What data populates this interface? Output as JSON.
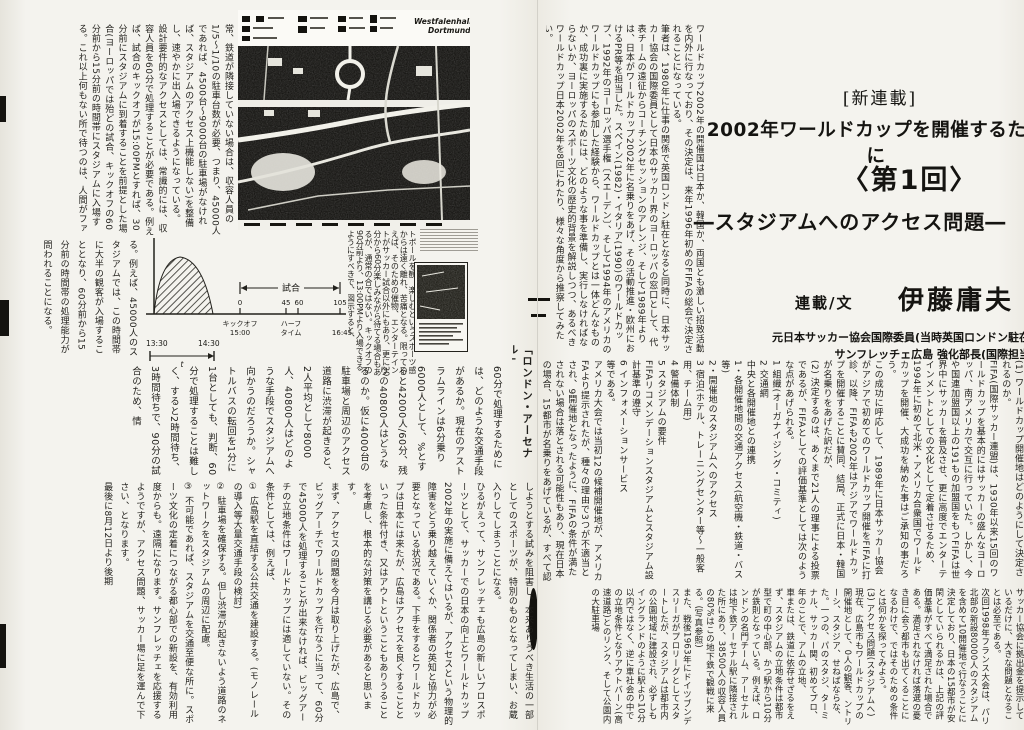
{
  "left_page": {
    "col_top_left": "常、鉄道が隣接していない場合は、収容人員の1/5〜1/10の駐車台数が必要、つまり、45000人であれば、4500台〜9000台の駐車場がなければ、スタジアムのアクセス上機能しない)を整備し、速やかに出入場できるようになっている。\n設計要件的なアクセスとしては、常識的には、収容人員を60分で処理することが必要である。例えば、試合のキックオフが15:00PMとすれば、30分前にスタジアムに到着することを前提とした場合(ヨーロッパでは殆どの試合、キックオフの60分前から15分前の時間帯にスタジアムに入場する。これ以上何もない所で待つのは、人間がファ",
    "col_below_left": "る。例えば、45000人のスタジアムでは、この時間帯に大半の観客が入場することとなり、60分前から15分前の時間帯の処理能力が問われることになる。",
    "map": {
      "title_line1": "Westfalenhallen",
      "title_line2": "Dortmund"
    },
    "col_right_of_diagram": "トボールを観、楽しむというスポーツ感からは遠く離れ、苦痛となる。限っていえば、そのための催物、エンターテイントがサッカー試合以外にもあり、更に30分から60分楽しみながら待てる場合もあるが、通常の合ではない。キックオフの90分前より、13:00PMより入場できるようにすべきで、図示すると、",
    "heading_arsenal": "「ロンドン・アーセナル」",
    "mid_band": "60分で処理するためには、どのような交通手段があるか。現在のアストラムラインは6分乗り6000人として、%とすると42000人/60分、残りの40800人はどうなるのか。仮に4000台の駐車場と周辺のアクセス道路に渋滞が起きると、2人平均として8000人、40800人はどのような手段でスタジアムへ向かうのだろうか。シャトルバスの転回を1分に1台としても、判断、60分で処理することは難しく、すると2時間待ち、3時間待ちで、90分の試合のため、情",
    "bottom_band": "しようとする試みを阻害し、本来ありうべき生活の一部としてのスポーツが、特別のものとなってしまい、お蔵入りしてしまうことになる。\nひるがえって、サンフレッチェも広島の新しいプロスポーツとして、サッカーでの日本の向上とワールドカップ2002年の実施に備えてはいるが、アクセスという物理的障害をどう乗り越えていくか、関係者の英知と協力が必要となっている状況である。下手をするとワールドカップは日本には来たが、広島はアクセスを良くすることといった条件付き、又はアウトということもありうることを考慮し、根本的な対策を講じる必要があると思います。\nまず、アクセスの問題を今月は取り上げたが、広島で、ビッグアーチでワールドカップを行なうに当って、60分で45000人を処理することが出来なければ、ビッグアーチの立地条件はワールドカップには適していない。その条件としては、例えば、\n① 広島駅を直結する公共交通を建設する。(モノレールの導入等大量交通手段の検討)\n② 駐車場を確保する。但し渋滞が起きないよう道路のネットワークをスタジアムの周辺に配慮。\n③ 不可能であれば、スタジアムを交通至便な所に。スポーツ文化の定着につながる都心部での新設を、有効利用度からも。遠隔になります。サンフレッチェを応援するようですが、アクセス問題、サッカー場に足を運んで下さい、となります。\n最後に8月12日より後期",
    "diagram": {
      "match_label": "試合",
      "tick_0": "0",
      "tick_45": "45",
      "tick_60": "60",
      "tick_105": "105",
      "kickoff_label": "キックオフ",
      "kickoff_time": "15:00",
      "halftime_label1": "ハーフ",
      "halftime_label2": "タイム",
      "end_time": "16:45",
      "arrive_start": "13:30",
      "arrive_end": "14:30",
      "t_label": "t"
    }
  },
  "right_page": {
    "lead": "ワールドカップ2002年の開催国は日本か、韓国か、両国とも激しい招致活動を内外に行なっており、その決定は、来年1996年初めのFIFAの総会で決定されることになっている。\n筆者は、1980年に仕事の関係で英国ロンドン駐在となると同時に、日本サッカー協会の国際委員として日本のサッカー界のヨーロッパの窓口として、代表チームの遠征からコーチングセッションのアレンジ、そして1989年よりは、日本がワールドカップ2002年に名乗りをあげ、その活動推進・欧州におけるPR等を担当した。スペイン(1982)・イタリア(1990)のワールドカップ、1992年のヨーロッパ選手権〔スエーデン〕、そして1994年のアメリカのワールドカップにも参加した経験から、ワールドカップとは一体どんなものか、成功裏に実施するためには、どのような事を準備し、実行しなければならないか、ヨーロッパのスポーツ文化の歴史的背景を解説しつつ、あるべきワールドカップ日本2002年を8回にわたり、様々な角度から推察してみたい。",
    "title": {
      "tag": "[新連載]",
      "series": "2002年ワールドカップを開催するために",
      "episode": "〈第1回〉",
      "subtitle": "―スタジアムへのアクセス問題―"
    },
    "byline": {
      "label": "連載/文",
      "author": "伊藤庸夫"
    },
    "credits": "元日本サッカー協会国際委員(当時英国ロンドン駐在\nサンフレッチェ広島 強化部長(国際担当",
    "mid_band": "(1) ワールドカップ開催地はどのようにして決定されるのか。\nFIFA(国際サッカー連盟)は、1930年以来15回のワールドカップを基本的にはサッカーの盛んなヨーロッパ、南アメリカで交互に行っていた。しかし、今や国連加盟国以上の191もの加盟国をもつFIFAは世界中にサッカーを普及させ、更に高度でエンターテインメントとしての文化として定着させるため、1994年に初めて北米・アメリカ合衆国でワールドカップを開催、大成功を納めた事はご承知の事だろう。\nこの成功に呼応して、1989年に日本サッカー協会がアジアで初めてのワールドカップ開催をFIFAに打診、以降、FIFAも2002年はアジアでワールドカップを開催することに賛同、結局、正式に日本・韓国が名乗りをあげた訳だが、\n(2) 決定するのは、あくまで21人の理事による投票であるが、FIFAとしての評価基準としては次のような点があげられる。\n1 組織(オーガナイジング・コミティ)\n2 交通網\n中央と各開催地との連携\n1・各開催地間の交通アクセス(航空機・鉄道・バス等)\n2・開催地のスタジアムへのアクセス\n3 宿泊(ホテル、トレーニングセンター等〜一般客用、チーム用)\n4 警備体制\n5 スタジアムの要件\nFIFAリコメンデーションスタジアムとスタジアム設計基準の遵守\n6 インフォメーションサービス\n等である。\nアメリカ大会では当初12の候補開催地が、アメリカFAより提示されたが、種々の理由で3つが不適当とされ、9開催地となったように、FIFAの条件が満たされない場合は落とされる可能性もあり、現在日本の場合、15都市が名乗りをあげているが、すべて認められるという保証はなく、",
    "bottom_band": "サッカー協会に拠出金を提示しているだけに、大きな問題となることは必至である。\n次回1998年フランス大会は、パリ北部の新設80000人のスタジアムを含めて10開催地で行なうことに決定しており、日本の15都市が安閑としていられるかは、上記の評価基準がすべて満足された場合である。満足されなければ落選の憂き目に会う都市も出てくることになるわけで、ではそのための条件とは何かを探ってみよう。\n(3) アクセス問題(スタジアムへ)\n現在、広島市もワールドカップの開催地として、0人の観客、ントリーシ、スタジア、せねばならな、た。一つの、パのスタジ、ターミナル、サッカー関、初めてプロ、年のことで、アムの立地、\n車または、鉄道に依存せざるをえず、スタジアムの立地条件は都市型で町の中心部、かつ駅から10分が鉄則となっている。例えば、ロンドンの名門チーム、アーセナルは地下鉄アーセナル駅に隣接された所にあり、38500人の収容人員の80%はこの地下鉄で観戦に来る。(写真参照)\nまた、戦後1963年にドイツブンデスリーガがプロリーグとしてスタートしたが、スタジアムは都市内の公園地域に建設され、必ずしもイングランドのように駅より10分以内ではなく、逆に車社会の中での立地条件となりアウトバーン(高速道路)とのリンク、そして公園内の大駐車場"
  },
  "chart_data": {
    "type": "area",
    "title": "スタジアム入場時間帯の図示(キックオフ前の入場の山)",
    "series": [
      {
        "name": "入場者の流れ(ハッチ部分)",
        "x": [
          "13:30",
          "13:45",
          "14:00",
          "14:15",
          "14:30"
        ],
        "relative_values": [
          0,
          0.75,
          1.0,
          0.7,
          0
        ]
      }
    ],
    "timeline": {
      "span_label": "試合",
      "ticks_min": [
        0,
        45,
        60,
        105
      ],
      "kickoff": {
        "label": "キックオフ",
        "time": "15:00",
        "minute": 0
      },
      "halftime": {
        "label": "ハーフタイム",
        "minutes": [
          45,
          60
        ]
      },
      "end_time": "16:45",
      "arrival_window": {
        "start": "13:30",
        "end": "14:30",
        "variable": "t"
      }
    },
    "grid": false,
    "legend_position": "none"
  }
}
